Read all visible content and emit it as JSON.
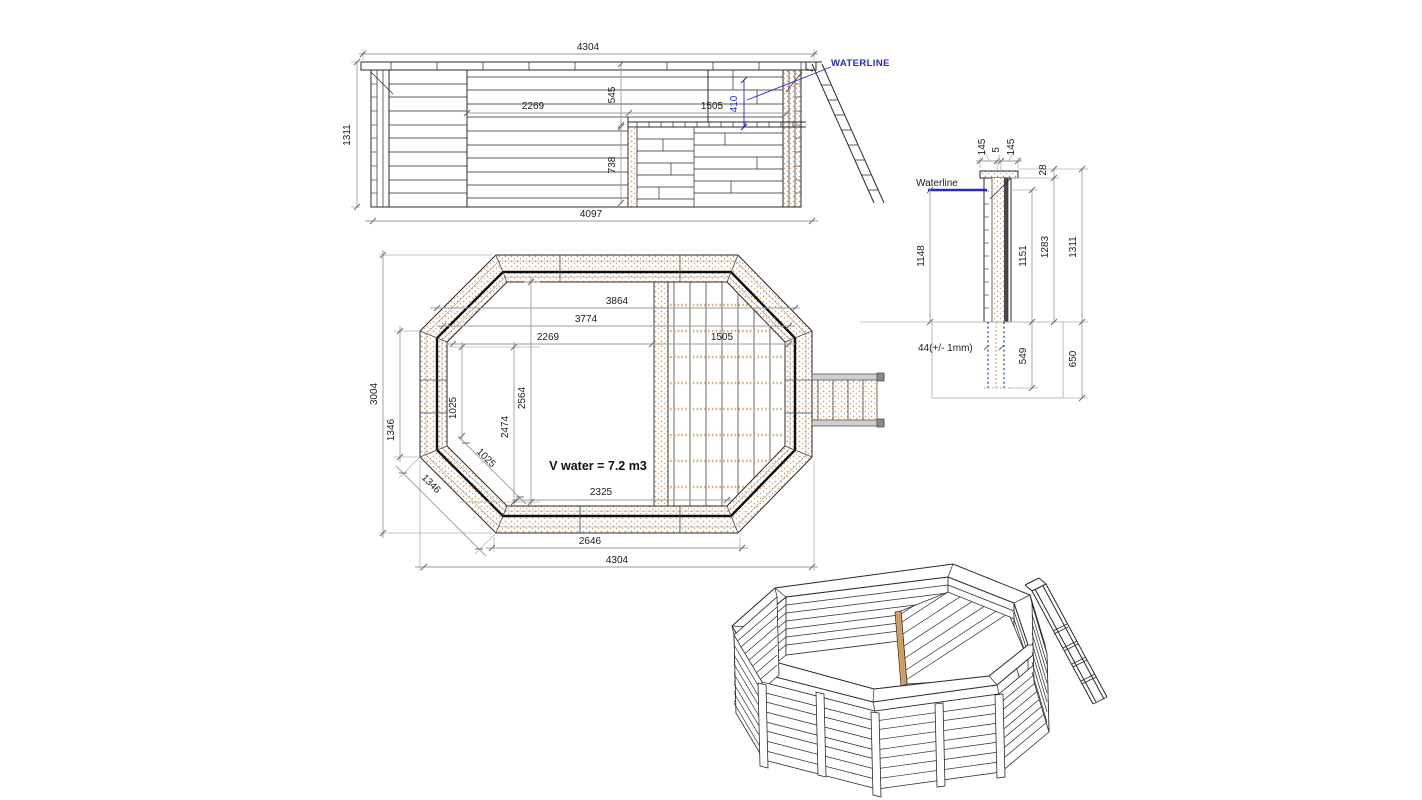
{
  "colors": {
    "accent_blue": "#2828c8",
    "wood_tan": "#c59a62",
    "line_dark": "#2a2a2a",
    "dimension_gray": "#9b9b9b"
  },
  "labels": {
    "elev": {
      "w_top": "4304",
      "h_left": "1311",
      "d_2269": "2269",
      "d_545": "545",
      "d_1505": "1505",
      "d_410": "410",
      "d_738": "738",
      "w_bot": "4097",
      "waterline": "WATERLINE"
    },
    "sect": {
      "waterline": "Waterline",
      "cap1": "145",
      "cap2": "5",
      "cap3": "145",
      "cap_h": "28",
      "d_1148": "1148",
      "d_1151": "1151",
      "d_1283": "1283",
      "d_1311": "1311",
      "d_44": "44(+/- 1mm)",
      "d_549": "549",
      "d_650": "650"
    },
    "plan": {
      "d_3864": "3864",
      "d_3774": "3774",
      "d_2269": "2269",
      "d_1505": "1505",
      "d_3004": "3004",
      "d_1346a": "1346",
      "d_1346b": "1346",
      "d_1025a": "1025",
      "d_1025b": "1025",
      "d_2474": "2474",
      "d_2564": "2564",
      "d_2325": "2325",
      "d_2646": "2646",
      "d_4304": "4304",
      "volume": "V water = 7.2 m3"
    }
  }
}
